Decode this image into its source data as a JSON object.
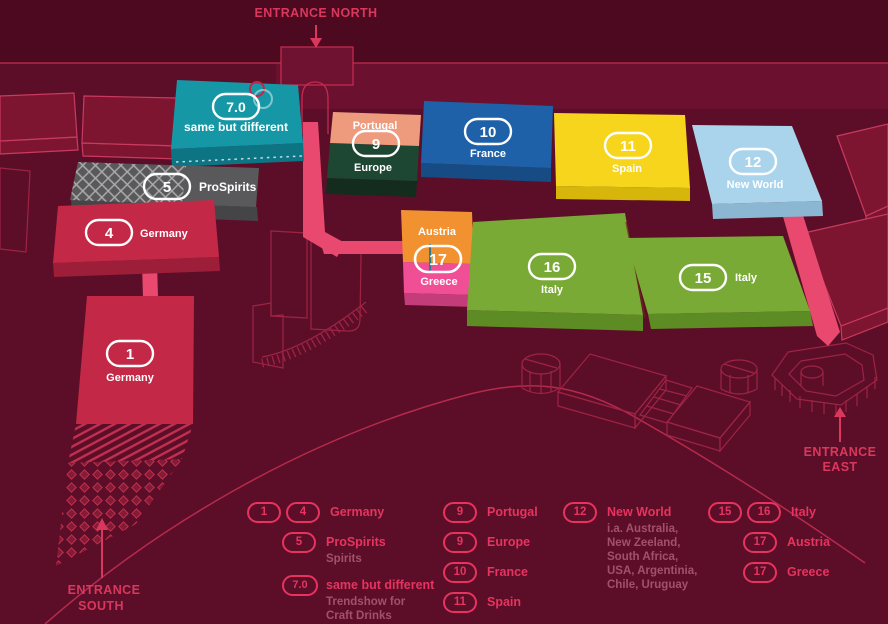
{
  "title": "Exhibition ground hall map",
  "colors": {
    "background": "#5c0e28",
    "top_band": "#4d0920",
    "accent_pink": "#e7335f",
    "path_pink": "#e9496f",
    "teal": "#1697a6",
    "gray": "#59595b",
    "red": "#c42847",
    "salmon": "#ee9a7d",
    "dark_green": "#1d4733",
    "blue": "#1e61a8",
    "yellow": "#f6d51c",
    "light_blue": "#a9d4ec",
    "orange": "#f19130",
    "greece_pink": "#f04f96",
    "italy_green": "#79aa35"
  },
  "entrances": {
    "north": "ENTRANCE NORTH",
    "east_line1": "ENTRANCE",
    "east_line2": "EAST",
    "south_line1": "ENTRANCE",
    "south_line2": "SOUTH"
  },
  "halls": {
    "same_but_different": {
      "badge": "7.0",
      "label": "same but different"
    },
    "prospirits": {
      "badge": "5",
      "label": "ProSpirits"
    },
    "germany_4": {
      "badge": "4",
      "label": "Germany"
    },
    "germany_1": {
      "badge": "1",
      "label": "Germany"
    },
    "portugal": {
      "badge": "9",
      "label": "Portugal"
    },
    "europe": {
      "label": "Europe"
    },
    "france": {
      "badge": "10",
      "label": "France"
    },
    "spain": {
      "badge": "11",
      "label": "Spain"
    },
    "new_world": {
      "badge": "12",
      "label": "New World"
    },
    "austria": {
      "label": "Austria"
    },
    "austria_greece": {
      "badge": "17"
    },
    "greece": {
      "label": "Greece"
    },
    "italy_16": {
      "badge": "16",
      "label": "Italy"
    },
    "italy_15": {
      "badge": "15",
      "label": "Italy"
    }
  },
  "legend": {
    "germany": {
      "badges": [
        "1",
        "4"
      ],
      "label": "Germany"
    },
    "prospirits": {
      "badge": "5",
      "label": "ProSpirits",
      "sub": "Spirits"
    },
    "same_but_different": {
      "badge": "7.0",
      "label": "same but different",
      "sub": "Trendshow for\nCraft Drinks"
    },
    "portugal": {
      "badge": "9",
      "label": "Portugal"
    },
    "europe": {
      "badge": "9",
      "label": "Europe"
    },
    "france": {
      "badge": "10",
      "label": "France"
    },
    "spain": {
      "badge": "11",
      "label": "Spain"
    },
    "new_world": {
      "badge": "12",
      "label": "New World",
      "sub": "i.a. Australia,\nNew Zeeland,\nSouth Africa,\nUSA, Argentinia,\nChile, Uruguay"
    },
    "italy": {
      "badges": [
        "15",
        "16"
      ],
      "label": "Italy"
    },
    "austria": {
      "badge": "17",
      "label": "Austria"
    },
    "greece": {
      "badge": "17",
      "label": "Greece"
    }
  }
}
